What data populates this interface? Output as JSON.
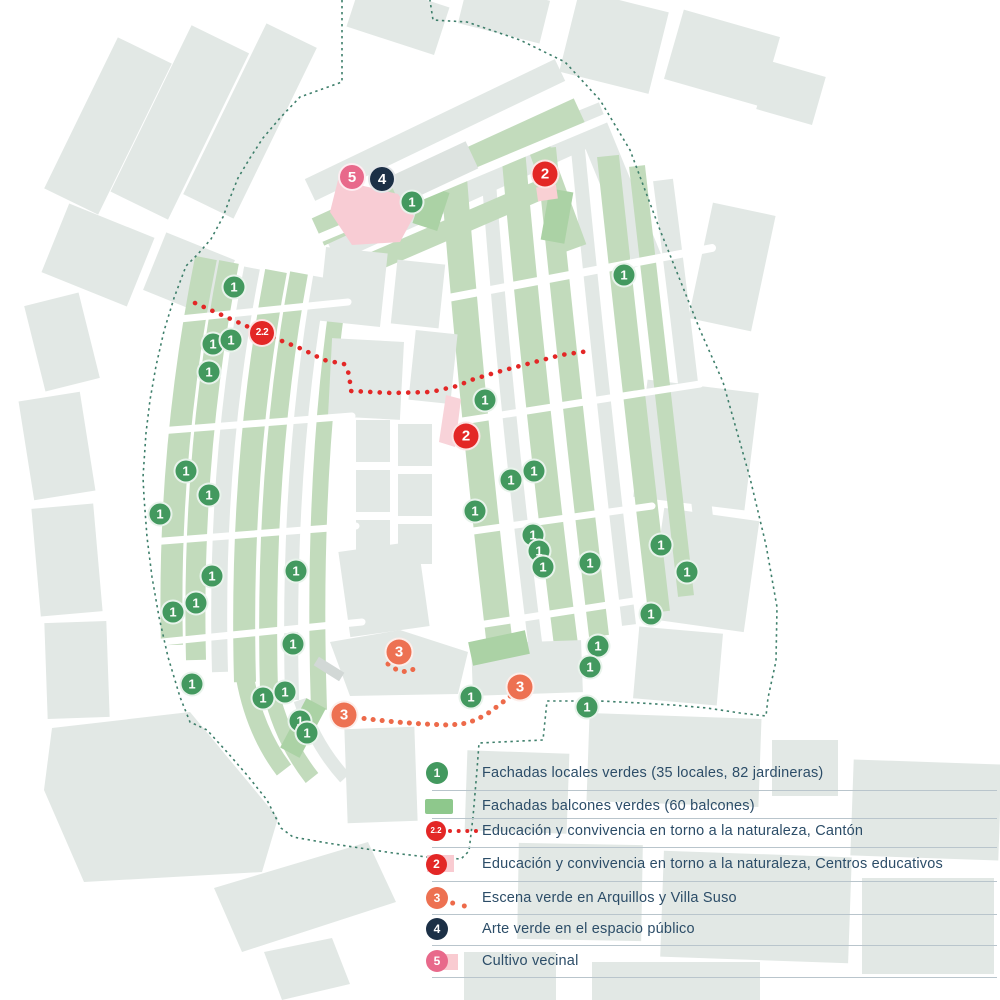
{
  "colors": {
    "background": "#ffffff",
    "building_pale": "#e2e8e5",
    "building_green": "#c2dbbc",
    "building_green_bright": "#abd2a5",
    "legend_swatch_green": "#8ec88c",
    "marker_green": "#43995f",
    "marker_red": "#e32726",
    "marker_orange": "#ed7152",
    "marker_navy": "#1c3046",
    "marker_pink": "#e8698b",
    "pink_area": "#f8ccd4",
    "legend_pink_square": "#f9cbd1",
    "route_red": "#e32726",
    "route_orange": "#ed6a4a",
    "boundary": "#3e7f6b",
    "legend_text": "#2c4d68",
    "legend_divider": "#b9c5cc"
  },
  "marker_styles": {
    "green": {
      "size": 25,
      "color": "#43995f",
      "font": 13
    },
    "red": {
      "size": 29,
      "color": "#e32726",
      "font": 15
    },
    "red-small": {
      "size": 28,
      "color": "#e32726",
      "font": 10
    },
    "orange": {
      "size": 29,
      "color": "#ed7152",
      "font": 15
    },
    "navy": {
      "size": 28,
      "color": "#1c3046",
      "font": 15
    },
    "pink": {
      "size": 28,
      "color": "#e8698b",
      "font": 15
    }
  },
  "legend": {
    "items": [
      {
        "number": "1",
        "label": "Fachadas locales verdes (35 locales, 82 jardineras)",
        "shape": "circle",
        "size": 22,
        "font": 12,
        "color": "#43995f",
        "extras": [],
        "y": 773,
        "divider_y": 790
      },
      {
        "number": "",
        "label": "Fachadas balcones verdes (60 balcones)",
        "shape": "square",
        "size": 0,
        "font": 0,
        "color": "#8ec88c",
        "extras": [],
        "y": 806,
        "divider_y": 818
      },
      {
        "number": "2.2",
        "label": "Educación y convivencia en torno a la naturaleza, Cantón",
        "shape": "circle",
        "size": 20,
        "font": 8,
        "color": "#e32726",
        "extras": [
          "dots-red"
        ],
        "y": 831,
        "divider_y": 847
      },
      {
        "number": "2",
        "label": "Educación y convivencia en torno a la naturaleza, Centros educativos",
        "shape": "circle",
        "size": 21,
        "font": 12,
        "color": "#e32726",
        "extras": [
          "pinksq-a"
        ],
        "y": 864,
        "divider_y": 881
      },
      {
        "number": "3",
        "label": "Escena verde en Arquillos y Villa Suso",
        "shape": "circle",
        "size": 22,
        "font": 12,
        "color": "#ed7152",
        "extras": [
          "dots-orange"
        ],
        "y": 898,
        "divider_y": 914
      },
      {
        "number": "4",
        "label": "Arte verde en el espacio público",
        "shape": "circle",
        "size": 22,
        "font": 12,
        "color": "#1c3046",
        "extras": [],
        "y": 929,
        "divider_y": 945
      },
      {
        "number": "5",
        "label": "Cultivo vecinal",
        "shape": "circle",
        "size": 22,
        "font": 12,
        "color": "#e8698b",
        "extras": [
          "pinksq-b"
        ],
        "y": 961,
        "divider_y": 977
      }
    ]
  },
  "map": {
    "markers": [
      {
        "label": "1",
        "kind": "green",
        "x": 412,
        "y": 202
      },
      {
        "label": "1",
        "kind": "green",
        "x": 624,
        "y": 275
      },
      {
        "label": "1",
        "kind": "green",
        "x": 234,
        "y": 287
      },
      {
        "label": "1",
        "kind": "green",
        "x": 213,
        "y": 344
      },
      {
        "label": "1",
        "kind": "green",
        "x": 231,
        "y": 340
      },
      {
        "label": "1",
        "kind": "green",
        "x": 209,
        "y": 372
      },
      {
        "label": "1",
        "kind": "green",
        "x": 186,
        "y": 471
      },
      {
        "label": "1",
        "kind": "green",
        "x": 209,
        "y": 495
      },
      {
        "label": "1",
        "kind": "green",
        "x": 160,
        "y": 514
      },
      {
        "label": "1",
        "kind": "green",
        "x": 296,
        "y": 571
      },
      {
        "label": "1",
        "kind": "green",
        "x": 212,
        "y": 576
      },
      {
        "label": "1",
        "kind": "green",
        "x": 196,
        "y": 603
      },
      {
        "label": "1",
        "kind": "green",
        "x": 173,
        "y": 612
      },
      {
        "label": "1",
        "kind": "green",
        "x": 293,
        "y": 644
      },
      {
        "label": "1",
        "kind": "green",
        "x": 192,
        "y": 684
      },
      {
        "label": "1",
        "kind": "green",
        "x": 263,
        "y": 698
      },
      {
        "label": "1",
        "kind": "green",
        "x": 285,
        "y": 692
      },
      {
        "label": "1",
        "kind": "green",
        "x": 300,
        "y": 721
      },
      {
        "label": "1",
        "kind": "green",
        "x": 307,
        "y": 733
      },
      {
        "label": "1",
        "kind": "green",
        "x": 485,
        "y": 400
      },
      {
        "label": "1",
        "kind": "green",
        "x": 511,
        "y": 480
      },
      {
        "label": "1",
        "kind": "green",
        "x": 534,
        "y": 471
      },
      {
        "label": "1",
        "kind": "green",
        "x": 475,
        "y": 511
      },
      {
        "label": "1",
        "kind": "green",
        "x": 533,
        "y": 535
      },
      {
        "label": "1",
        "kind": "green",
        "x": 539,
        "y": 551
      },
      {
        "label": "1",
        "kind": "green",
        "x": 543,
        "y": 567
      },
      {
        "label": "1",
        "kind": "green",
        "x": 590,
        "y": 563
      },
      {
        "label": "1",
        "kind": "green",
        "x": 661,
        "y": 545
      },
      {
        "label": "1",
        "kind": "green",
        "x": 687,
        "y": 572
      },
      {
        "label": "1",
        "kind": "green",
        "x": 651,
        "y": 614
      },
      {
        "label": "1",
        "kind": "green",
        "x": 598,
        "y": 646
      },
      {
        "label": "1",
        "kind": "green",
        "x": 590,
        "y": 667
      },
      {
        "label": "1",
        "kind": "green",
        "x": 587,
        "y": 707
      },
      {
        "label": "1",
        "kind": "green",
        "x": 471,
        "y": 697
      },
      {
        "label": "2",
        "kind": "red",
        "x": 545,
        "y": 174
      },
      {
        "label": "2",
        "kind": "red",
        "x": 466,
        "y": 436
      },
      {
        "label": "2.2",
        "kind": "red-small",
        "x": 262,
        "y": 333
      },
      {
        "label": "3",
        "kind": "orange",
        "x": 399,
        "y": 652
      },
      {
        "label": "3",
        "kind": "orange",
        "x": 520,
        "y": 687
      },
      {
        "label": "3",
        "kind": "orange",
        "x": 344,
        "y": 715
      },
      {
        "label": "4",
        "kind": "navy",
        "x": 382,
        "y": 179
      },
      {
        "label": "5",
        "kind": "pink",
        "x": 352,
        "y": 177
      }
    ],
    "routes": [
      {
        "name": "route-canton",
        "color": "#e32726",
        "width": 4.6,
        "gap": 9.4,
        "points": [
          [
            195,
            303
          ],
          [
            262,
            333
          ],
          [
            302,
            349
          ],
          [
            324,
            360
          ],
          [
            344,
            364
          ],
          [
            349,
            374
          ],
          [
            351,
            391
          ],
          [
            392,
            393
          ],
          [
            431,
            392
          ],
          [
            457,
            386
          ],
          [
            474,
            379
          ],
          [
            501,
            371
          ],
          [
            531,
            363
          ],
          [
            561,
            355
          ],
          [
            589,
            351
          ]
        ]
      },
      {
        "name": "route-escena-a",
        "color": "#ed6a4a",
        "width": 5,
        "gap": 9,
        "points": [
          [
            388,
            664
          ],
          [
            397,
            670
          ],
          [
            407,
            672
          ],
          [
            414,
            669
          ],
          [
            419,
            665
          ]
        ]
      },
      {
        "name": "route-escena-b",
        "color": "#ed6a4a",
        "width": 5,
        "gap": 9,
        "points": [
          [
            346,
            716
          ],
          [
            368,
            719
          ],
          [
            396,
            722
          ],
          [
            424,
            724
          ],
          [
            448,
            725
          ],
          [
            462,
            724
          ],
          [
            476,
            720
          ],
          [
            490,
            712
          ],
          [
            503,
            702
          ],
          [
            514,
            693
          ],
          [
            521,
            687
          ]
        ]
      }
    ],
    "boundary": {
      "color": "#3e7f6b",
      "points": [
        [
          342,
          -6
        ],
        [
          342,
          82
        ],
        [
          300,
          97
        ],
        [
          280,
          118
        ],
        [
          263,
          138
        ],
        [
          250,
          158
        ],
        [
          238,
          178
        ],
        [
          230,
          198
        ],
        [
          223,
          217
        ],
        [
          211,
          239
        ],
        [
          198,
          254
        ],
        [
          186,
          266
        ],
        [
          174,
          298
        ],
        [
          164,
          331
        ],
        [
          156,
          366
        ],
        [
          150,
          400
        ],
        [
          146,
          433
        ],
        [
          143,
          477
        ],
        [
          144,
          497
        ],
        [
          147,
          537
        ],
        [
          152,
          577
        ],
        [
          159,
          617
        ],
        [
          168,
          657
        ],
        [
          180,
          697
        ],
        [
          190,
          722
        ],
        [
          207,
          730
        ],
        [
          227,
          752
        ],
        [
          247,
          775
        ],
        [
          267,
          800
        ],
        [
          281,
          828
        ],
        [
          293,
          837
        ],
        [
          327,
          843
        ],
        [
          360,
          848
        ],
        [
          393,
          853
        ],
        [
          427,
          857
        ],
        [
          461,
          859
        ],
        [
          469,
          851
        ],
        [
          473,
          817
        ],
        [
          477,
          770
        ],
        [
          479,
          743
        ],
        [
          543,
          740
        ],
        [
          547,
          701
        ],
        [
          600,
          701
        ],
        [
          640,
          703
        ],
        [
          673,
          705
        ],
        [
          707,
          708
        ],
        [
          740,
          713
        ],
        [
          766,
          716
        ],
        [
          768,
          698
        ],
        [
          776,
          661
        ],
        [
          777,
          607
        ],
        [
          766,
          545
        ],
        [
          750,
          478
        ],
        [
          723,
          382
        ],
        [
          700,
          330
        ],
        [
          660,
          230
        ],
        [
          630,
          150
        ],
        [
          600,
          100
        ],
        [
          565,
          62
        ],
        [
          520,
          40
        ],
        [
          467,
          22
        ],
        [
          433,
          20
        ],
        [
          429,
          -6
        ]
      ]
    }
  }
}
